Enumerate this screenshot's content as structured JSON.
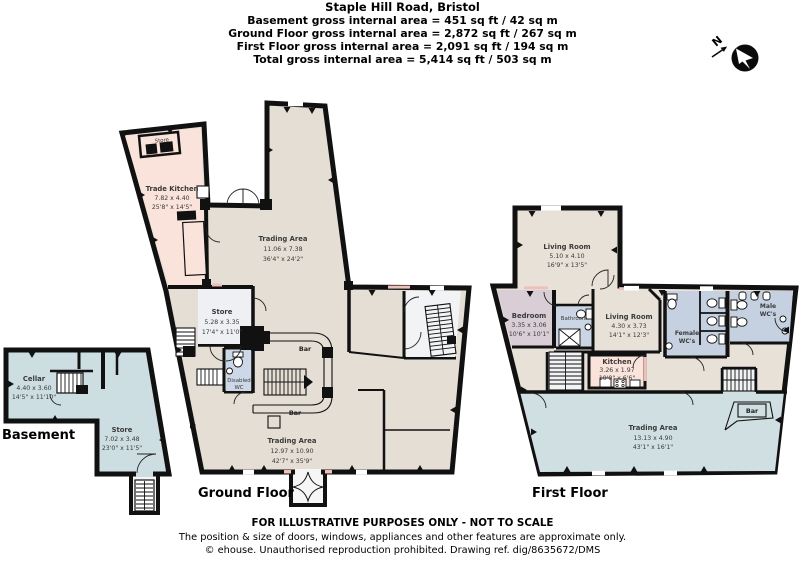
{
  "header": {
    "title": "Staple Hill Road, Bristol",
    "lines": [
      "Basement gross internal area = 451 sq ft / 42 sq m",
      "Ground Floor gross internal area = 2,872 sq ft / 267 sq m",
      "First Floor gross internal area = 2,091 sq ft / 194 sq m",
      "Total gross internal area = 5,414 sq ft / 503 sq m"
    ]
  },
  "compass": {
    "letter": "N"
  },
  "floors": {
    "basement": {
      "label": "Basement",
      "rooms": [
        {
          "name": "Cellar",
          "metric": "4.40 x 3.60",
          "imperial": "14'5\" x 11'10\""
        },
        {
          "name": "Store",
          "metric": "7.02 x 3.48",
          "imperial": "23'0\" x 11'5\""
        }
      ]
    },
    "ground": {
      "label": "Ground Floor",
      "rooms": [
        {
          "name": "Store"
        },
        {
          "name": "Trade Kitchen",
          "metric": "7.82 x 4.40",
          "imperial": "25'8\" x 14'5\""
        },
        {
          "name": "Trading Area",
          "metric": "11.06 x 7.38",
          "imperial": "36'4\" x 24'2\""
        },
        {
          "name": "Store",
          "metric": "5.28 x 3.35",
          "imperial": "17'4\" x 11'0\""
        },
        {
          "name": "Disabled",
          "name2": "WC"
        },
        {
          "name": "Bar"
        },
        {
          "name": "Bar"
        },
        {
          "name": "Trading Area",
          "metric": "12.97 x 10.90",
          "imperial": "42'7\" x 35'9\""
        }
      ]
    },
    "first": {
      "label": "First Floor",
      "rooms": [
        {
          "name": "Living Room",
          "metric": "5.10 x 4.10",
          "imperial": "16'9\" x 13'5\""
        },
        {
          "name": "Bedroom",
          "metric": "3.35 x 3.06",
          "imperial": "10'6\" x 10'1\""
        },
        {
          "name": "Bathroom"
        },
        {
          "name": "Living Room",
          "metric": "4.30 x 3.73",
          "imperial": "14'1\" x 12'3\""
        },
        {
          "name": "Kitchen",
          "metric": "3.26 x 1.97",
          "imperial": "10'8\" x 6'6\""
        },
        {
          "name": "Female",
          "name2": "WC's"
        },
        {
          "name": "Male",
          "name2": "WC's"
        },
        {
          "name": "Trading Area",
          "metric": "13.13 x 4.90",
          "imperial": "43'1\" x 16'1\""
        },
        {
          "name": "Bar"
        }
      ]
    }
  },
  "footer": {
    "lines": [
      "FOR ILLUSTRATIVE PURPOSES ONLY - NOT TO SCALE",
      "The position & size of doors, windows, appliances and other features are approximate only.",
      "© ehouse. Unauthorised reproduction prohibited. Drawing ref. dig/8635672/DMS"
    ]
  },
  "palette": {
    "wall": "#111111",
    "beige_floor": "#e4ded5",
    "pink_kitchen": "#fae3da",
    "blue_trading": "#cfdfe2",
    "blue_wc": "#c5d1e1",
    "mauve_bedroom": "#d9cdd6",
    "grey_store": "#eef0f3",
    "window_mark": "#eec0ba"
  }
}
